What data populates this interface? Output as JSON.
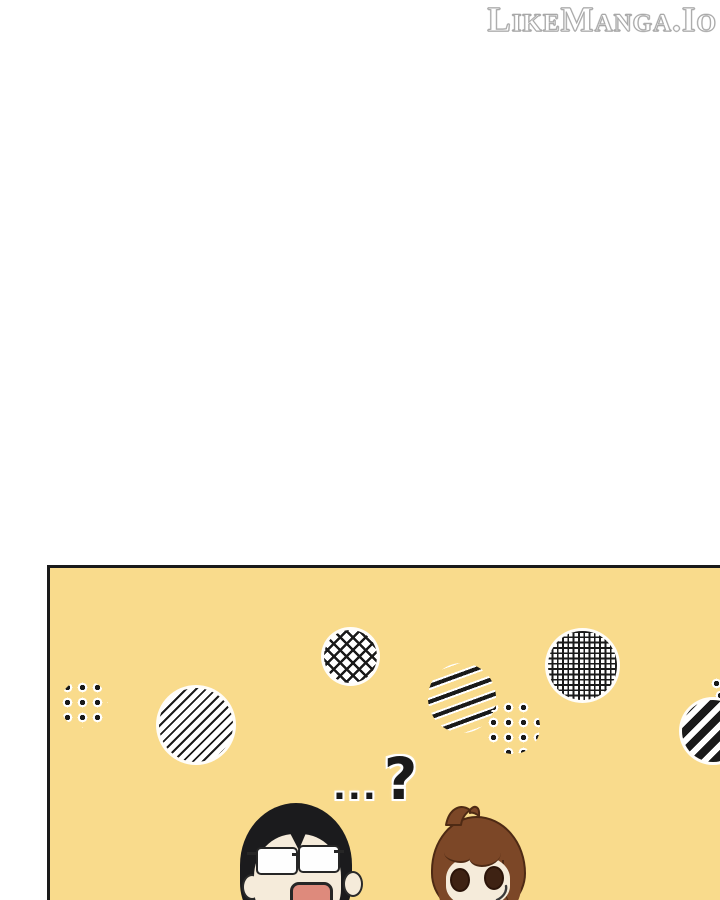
{
  "watermark": {
    "text": "LikeManga.Io"
  },
  "speech": {
    "ellipsis": "...",
    "question": "?"
  },
  "panel": {
    "patterns": [
      "dots-cluster-left",
      "diagonal-lines-circle",
      "crosshatch-diamond-circle",
      "steep-lines-cluster",
      "dots-cluster-mid",
      "fine-mesh-circle",
      "thick-stripes-circle",
      "edge-dots"
    ],
    "characters": [
      {
        "id": "left",
        "features": "long black hair, rectangular glasses, open mouth"
      },
      {
        "id": "right",
        "features": "brown hair with ahoge, round brown eyes, sweat drop"
      }
    ]
  },
  "colors": {
    "paper_white": "#FFFFFF",
    "panel_yellow": "#F9DB8C",
    "ink": "#1A1A1A",
    "skin": "#F5EBDA",
    "mouth_pink": "#DE8A7C",
    "hair_black": "#1B1B1D",
    "hair_brown": "#7C4727",
    "hair_brown_outline": "#4E2A14",
    "eye_brown": "#3E2213",
    "watermark_outline": "#A8A8A8"
  }
}
